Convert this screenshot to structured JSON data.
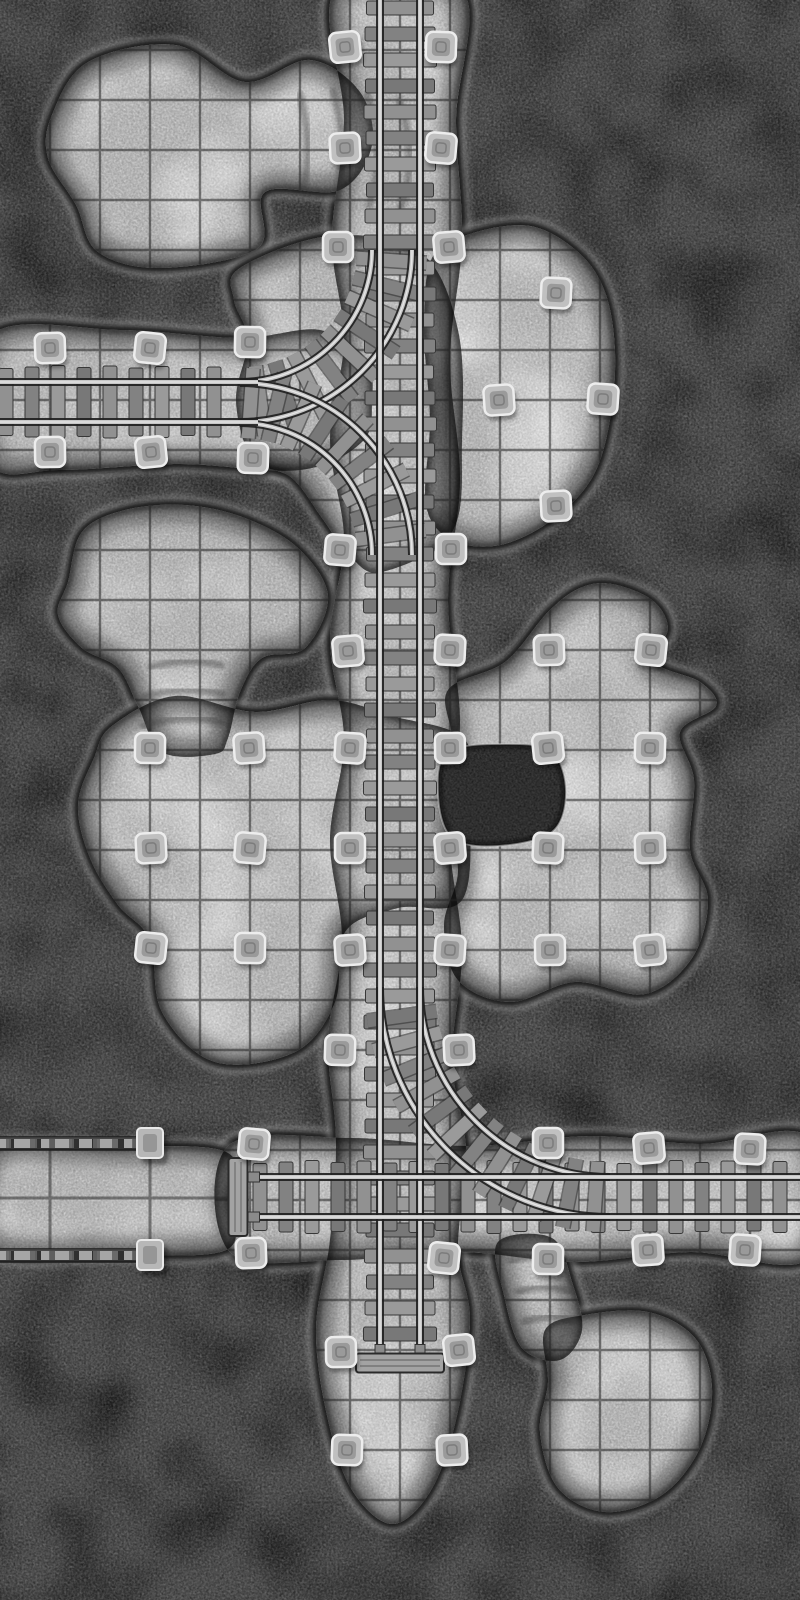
{
  "meta": {
    "description": "Grayscale top-down mine cave battle map with minecart rail tracks, stone pillars and walled corridor",
    "width": 800,
    "height": 1600,
    "grid_cell_px": 50
  },
  "palette": {
    "rock_bg": "#4f4f4f",
    "rock_patch": "#2f2f2f",
    "floor": "#b4b4b4",
    "floor_bright": "#e2e2e2",
    "grid_line": "#232323",
    "edge_dark": "#0b0b0b",
    "edge_highlight": "#cdcdcd",
    "tie_wood": "#8a8a8a",
    "tie_dark": "#383838",
    "rail_light": "#c6c6c6",
    "rail_dark": "#1f1f1f",
    "rail_sheen": "#ededed",
    "pillar_fill": "#c0c0c0",
    "pillar_edge": "#ededed",
    "pillar_core": "#939393",
    "pit_fill": "#3b3b3b",
    "wall_dark": "#303030",
    "wall_rubble": "#a6a6a6",
    "buffer_wood": "#a3a3a3"
  },
  "grid": {
    "cell": 50,
    "corridor": {
      "cell": 100,
      "vlines": [
        50,
        150
      ],
      "hline": 1198,
      "y0": 1145,
      "y1": 1255,
      "x1": 231
    }
  },
  "caves": [
    {
      "id": "west-track-hall",
      "points": [
        [
          -10,
          336
        ],
        [
          120,
          330
        ],
        [
          240,
          338
        ],
        [
          320,
          330
        ],
        [
          366,
          360
        ],
        [
          372,
          402
        ],
        [
          362,
          442
        ],
        [
          300,
          470
        ],
        [
          180,
          464
        ],
        [
          60,
          470
        ],
        [
          -10,
          462
        ]
      ]
    },
    {
      "id": "south-track-hall",
      "points": [
        [
          228,
          1146
        ],
        [
          350,
          1138
        ],
        [
          470,
          1146
        ],
        [
          590,
          1136
        ],
        [
          700,
          1144
        ],
        [
          810,
          1138
        ],
        [
          810,
          1258
        ],
        [
          690,
          1252
        ],
        [
          575,
          1262
        ],
        [
          460,
          1252
        ],
        [
          340,
          1260
        ],
        [
          230,
          1252
        ]
      ]
    },
    {
      "id": "central-shaft-corridor",
      "points": [
        [
          336,
          -10
        ],
        [
          462,
          -10
        ],
        [
          456,
          120
        ],
        [
          462,
          240
        ],
        [
          450,
          360
        ],
        [
          460,
          480
        ],
        [
          448,
          600
        ],
        [
          460,
          720
        ],
        [
          450,
          840
        ],
        [
          462,
          950
        ],
        [
          452,
          1060
        ],
        [
          466,
          1150
        ],
        [
          458,
          1250
        ],
        [
          470,
          1320
        ],
        [
          456,
          1420
        ],
        [
          430,
          1492
        ],
        [
          392,
          1524
        ],
        [
          352,
          1490
        ],
        [
          328,
          1420
        ],
        [
          316,
          1330
        ],
        [
          330,
          1240
        ],
        [
          336,
          1140
        ],
        [
          328,
          1040
        ],
        [
          342,
          940
        ],
        [
          330,
          840
        ],
        [
          344,
          740
        ],
        [
          330,
          640
        ],
        [
          344,
          540
        ],
        [
          330,
          440
        ],
        [
          344,
          340
        ],
        [
          332,
          240
        ],
        [
          344,
          120
        ]
      ]
    },
    {
      "id": "northwest-cavern",
      "points": [
        [
          52,
          115
        ],
        [
          88,
          62
        ],
        [
          175,
          45
        ],
        [
          245,
          82
        ],
        [
          310,
          60
        ],
        [
          360,
          92
        ],
        [
          372,
          145
        ],
        [
          340,
          190
        ],
        [
          265,
          192
        ],
        [
          258,
          248
        ],
        [
          162,
          268
        ],
        [
          98,
          252
        ],
        [
          76,
          205
        ],
        [
          48,
          158
        ]
      ]
    },
    {
      "id": "junction-cavern",
      "points": [
        [
          240,
          268
        ],
        [
          330,
          236
        ],
        [
          420,
          252
        ],
        [
          458,
          330
        ],
        [
          462,
          440
        ],
        [
          452,
          532
        ],
        [
          382,
          572
        ],
        [
          350,
          556
        ],
        [
          322,
          518
        ],
        [
          292,
          478
        ],
        [
          252,
          458
        ],
        [
          236,
          400
        ],
        [
          248,
          340
        ],
        [
          234,
          300
        ]
      ]
    },
    {
      "id": "round-cavern",
      "points": [
        [
          432,
          258
        ],
        [
          470,
          234
        ],
        [
          530,
          226
        ],
        [
          578,
          252
        ],
        [
          605,
          292
        ],
        [
          615,
          352
        ],
        [
          610,
          420
        ],
        [
          592,
          478
        ],
        [
          552,
          520
        ],
        [
          500,
          545
        ],
        [
          452,
          540
        ],
        [
          426,
          505
        ],
        [
          430,
          420
        ],
        [
          424,
          330
        ]
      ]
    },
    {
      "id": "mushroom-cavern",
      "points": [
        [
          68,
          582
        ],
        [
          82,
          532
        ],
        [
          125,
          510
        ],
        [
          185,
          505
        ],
        [
          245,
          518
        ],
        [
          298,
          548
        ],
        [
          328,
          596
        ],
        [
          305,
          648
        ],
        [
          262,
          658
        ],
        [
          240,
          692
        ],
        [
          228,
          738
        ],
        [
          215,
          754
        ],
        [
          162,
          752
        ],
        [
          138,
          706
        ],
        [
          118,
          668
        ],
        [
          82,
          648
        ],
        [
          58,
          615
        ]
      ]
    },
    {
      "id": "west-cross-cavern",
      "points": [
        [
          112,
          726
        ],
        [
          175,
          696
        ],
        [
          255,
          712
        ],
        [
          330,
          700
        ],
        [
          392,
          716
        ],
        [
          465,
          740
        ],
        [
          470,
          808
        ],
        [
          462,
          900
        ],
        [
          398,
          908
        ],
        [
          345,
          932
        ],
        [
          335,
          1002
        ],
        [
          295,
          1052
        ],
        [
          215,
          1062
        ],
        [
          162,
          1012
        ],
        [
          150,
          940
        ],
        [
          118,
          905
        ],
        [
          90,
          858
        ],
        [
          78,
          805
        ],
        [
          94,
          758
        ]
      ]
    },
    {
      "id": "east-complex-cavern",
      "points": [
        [
          448,
          690
        ],
        [
          505,
          662
        ],
        [
          548,
          612
        ],
        [
          580,
          588
        ],
        [
          612,
          584
        ],
        [
          652,
          600
        ],
        [
          668,
          628
        ],
        [
          655,
          662
        ],
        [
          700,
          682
        ],
        [
          716,
          706
        ],
        [
          680,
          732
        ],
        [
          694,
          780
        ],
        [
          690,
          850
        ],
        [
          708,
          900
        ],
        [
          692,
          958
        ],
        [
          645,
          994
        ],
        [
          575,
          982
        ],
        [
          510,
          1002
        ],
        [
          458,
          980
        ],
        [
          444,
          925
        ],
        [
          458,
          870
        ],
        [
          444,
          800
        ],
        [
          452,
          740
        ]
      ]
    },
    {
      "id": "walled-corridor",
      "points": [
        [
          -10,
          1152
        ],
        [
          112,
          1147
        ],
        [
          226,
          1152
        ],
        [
          230,
          1200
        ],
        [
          226,
          1250
        ],
        [
          112,
          1254
        ],
        [
          -10,
          1249
        ]
      ]
    },
    {
      "id": "southeast-tunnel",
      "points": [
        [
          498,
          1242
        ],
        [
          552,
          1238
        ],
        [
          572,
          1282
        ],
        [
          582,
          1330
        ],
        [
          560,
          1360
        ],
        [
          522,
          1348
        ],
        [
          504,
          1295
        ]
      ]
    },
    {
      "id": "southeast-cavern",
      "points": [
        [
          545,
          1330
        ],
        [
          585,
          1315
        ],
        [
          648,
          1312
        ],
        [
          695,
          1338
        ],
        [
          712,
          1388
        ],
        [
          700,
          1448
        ],
        [
          662,
          1495
        ],
        [
          605,
          1512
        ],
        [
          558,
          1488
        ],
        [
          540,
          1432
        ],
        [
          548,
          1382
        ]
      ]
    }
  ],
  "pits": [
    {
      "id": "rock-pit",
      "points": [
        [
          448,
          752
        ],
        [
          508,
          744
        ],
        [
          552,
          752
        ],
        [
          566,
          792
        ],
        [
          552,
          832
        ],
        [
          498,
          846
        ],
        [
          452,
          838
        ],
        [
          438,
          795
        ]
      ]
    }
  ],
  "ridges": [
    {
      "id": "north-tunnel-ridge-1",
      "d": "M299,92 Q316,150 300,200"
    },
    {
      "id": "north-tunnel-ridge-2",
      "d": "M332,88 Q352,150 334,206"
    },
    {
      "id": "north-tunnel-ridge-3",
      "d": "M366,92 Q388,152 368,208"
    },
    {
      "id": "north-tunnel-ridge-4",
      "d": "M398,98 Q420,155 400,210"
    },
    {
      "id": "mushroom-neck-ridge-1",
      "d": "M148,668 Q188,655 224,666"
    },
    {
      "id": "mushroom-neck-ridge-2",
      "d": "M140,698 Q184,684 226,695"
    },
    {
      "id": "mushroom-neck-ridge-3",
      "d": "M140,727 Q184,713 224,723"
    },
    {
      "id": "se-tunnel-ridge-1",
      "d": "M508,1262 Q540,1250 568,1262"
    },
    {
      "id": "se-tunnel-ridge-2",
      "d": "M515,1293 Q546,1281 573,1293"
    },
    {
      "id": "se-tunnel-ridge-3",
      "d": "M522,1323 Q552,1311 578,1322"
    }
  ],
  "tracks": {
    "gauge": 40,
    "tie_length": 70,
    "tie_thickness": 14,
    "tie_step": 26,
    "straight": [
      {
        "id": "north-main-line",
        "axis": "v",
        "c": 400,
        "from": -5,
        "to": 1352,
        "tieFrom": 8,
        "tieTo": 1345
      },
      {
        "id": "west-branch-line",
        "axis": "h",
        "c": 402,
        "from": -5,
        "to": 258,
        "tieFrom": 6,
        "tieTo": 222
      },
      {
        "id": "south-main-line",
        "axis": "h",
        "c": 1197,
        "from": 252,
        "to": 805,
        "tieFrom": 260,
        "tieTo": 800
      }
    ],
    "curves": [
      {
        "id": "wye-north-curve",
        "cx": 240,
        "cy": 250,
        "r": 152,
        "a0": 90,
        "a1": 0
      },
      {
        "id": "wye-south-curve",
        "cx": 240,
        "cy": 555,
        "r": 152,
        "a0": 270,
        "a1": 360
      },
      {
        "id": "southeast-junction-curve",
        "cx": 610,
        "cy": 987,
        "r": 210,
        "a0": 180,
        "a1": 90
      }
    ],
    "buffers": [
      {
        "id": "west-end-buffer",
        "orient": "v",
        "cx": 238,
        "cy": 1197,
        "len": 78,
        "th": 19
      },
      {
        "id": "south-end-buffer",
        "orient": "h",
        "cx": 400,
        "cy": 1363,
        "len": 88,
        "th": 19
      }
    ]
  },
  "walls": {
    "bands": [
      {
        "id": "corridor-wall-north",
        "x": -4,
        "y": 1137,
        "w": 150,
        "h": 13
      },
      {
        "id": "corridor-wall-south",
        "x": -4,
        "y": 1249,
        "w": 150,
        "h": 13
      }
    ],
    "posts": [
      [
        150,
        1143
      ],
      [
        150,
        1255
      ]
    ]
  },
  "pillars": [
    [
      345,
      47
    ],
    [
      441,
      47
    ],
    [
      345,
      148
    ],
    [
      441,
      148
    ],
    [
      338,
      247
    ],
    [
      449,
      247
    ],
    [
      556,
      293
    ],
    [
      50,
      348
    ],
    [
      150,
      348
    ],
    [
      250,
      342
    ],
    [
      499,
      400
    ],
    [
      603,
      399
    ],
    [
      50,
      452
    ],
    [
      151,
      452
    ],
    [
      253,
      458
    ],
    [
      556,
      506
    ],
    [
      340,
      550
    ],
    [
      451,
      549
    ],
    [
      348,
      651
    ],
    [
      450,
      650
    ],
    [
      549,
      650
    ],
    [
      651,
      650
    ],
    [
      150,
      748
    ],
    [
      249,
      748
    ],
    [
      350,
      748
    ],
    [
      450,
      748
    ],
    [
      548,
      748
    ],
    [
      650,
      748
    ],
    [
      151,
      848
    ],
    [
      250,
      848
    ],
    [
      350,
      848
    ],
    [
      450,
      848
    ],
    [
      548,
      848
    ],
    [
      650,
      848
    ],
    [
      151,
      948
    ],
    [
      250,
      948
    ],
    [
      350,
      950
    ],
    [
      450,
      950
    ],
    [
      550,
      950
    ],
    [
      650,
      950
    ],
    [
      340,
      1050
    ],
    [
      459,
      1050
    ],
    [
      254,
      1144
    ],
    [
      548,
      1143
    ],
    [
      649,
      1148
    ],
    [
      750,
      1149
    ],
    [
      251,
      1253
    ],
    [
      444,
      1258
    ],
    [
      548,
      1259
    ],
    [
      648,
      1250
    ],
    [
      745,
      1250
    ],
    [
      341,
      1352
    ],
    [
      459,
      1350
    ],
    [
      347,
      1450
    ],
    [
      452,
      1450
    ]
  ]
}
